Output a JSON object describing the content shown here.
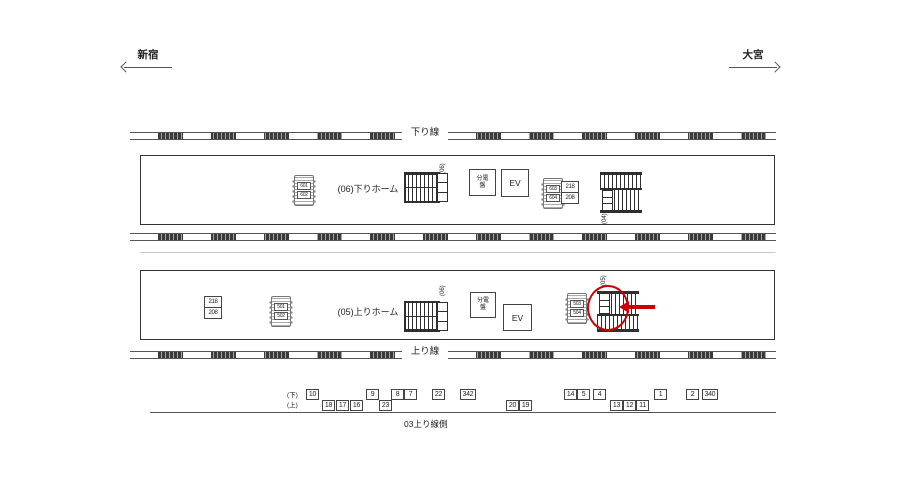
{
  "header": {
    "left_station": "新宿",
    "right_station": "大宮"
  },
  "tracks": {
    "down_line_label": "下り線",
    "up_line_label": "上り線"
  },
  "platform_down": {
    "name": "(06)下りホーム",
    "bench_left": {
      "top": "601",
      "bottom": "602"
    },
    "bench_right": {
      "top": "603",
      "bottom": "604"
    },
    "sign_box": {
      "top": "218",
      "bottom": "208"
    },
    "stair_left_label": "(06)",
    "stair_right_label": "(04)",
    "panel_label": "分電盤",
    "elevator_label": "EV"
  },
  "platform_up": {
    "name": "(05)上りホーム",
    "bench_left": {
      "top": "501",
      "bottom": "502"
    },
    "bench_right": {
      "top": "503",
      "bottom": "504"
    },
    "sign_box": {
      "top": "218",
      "bottom": "208"
    },
    "stair_left_label": "(06)",
    "stair_right_label": "(05)",
    "panel_label": "分電盤",
    "elevator_label": "EV"
  },
  "highlight": {
    "color": "#cc0000"
  },
  "bottom": {
    "row_down_label": "(下)",
    "row_up_label": "(上)",
    "boxes": [
      {
        "label": "10",
        "row": "upper",
        "x": 306
      },
      {
        "label": "18",
        "row": "lower",
        "x": 322
      },
      {
        "label": "17",
        "row": "lower",
        "x": 336
      },
      {
        "label": "16",
        "row": "lower",
        "x": 350
      },
      {
        "label": "9",
        "row": "upper",
        "x": 366
      },
      {
        "label": "23",
        "row": "lower",
        "x": 379
      },
      {
        "label": "8",
        "row": "upper",
        "x": 391
      },
      {
        "label": "7",
        "row": "upper",
        "x": 404
      },
      {
        "label": "22",
        "row": "upper",
        "x": 432
      },
      {
        "label": "342",
        "row": "upper",
        "x": 460
      },
      {
        "label": "20",
        "row": "lower",
        "x": 506
      },
      {
        "label": "19",
        "row": "lower",
        "x": 519
      },
      {
        "label": "14",
        "row": "upper",
        "x": 564
      },
      {
        "label": "5",
        "row": "upper",
        "x": 577
      },
      {
        "label": "4",
        "row": "upper",
        "x": 593
      },
      {
        "label": "13",
        "row": "lower",
        "x": 610
      },
      {
        "label": "12",
        "row": "lower",
        "x": 623
      },
      {
        "label": "11",
        "row": "lower",
        "x": 636
      },
      {
        "label": "1",
        "row": "upper",
        "x": 654
      },
      {
        "label": "2",
        "row": "upper",
        "x": 686
      },
      {
        "label": "340",
        "row": "upper",
        "x": 702
      }
    ],
    "baseline_label": "03上り線側"
  }
}
